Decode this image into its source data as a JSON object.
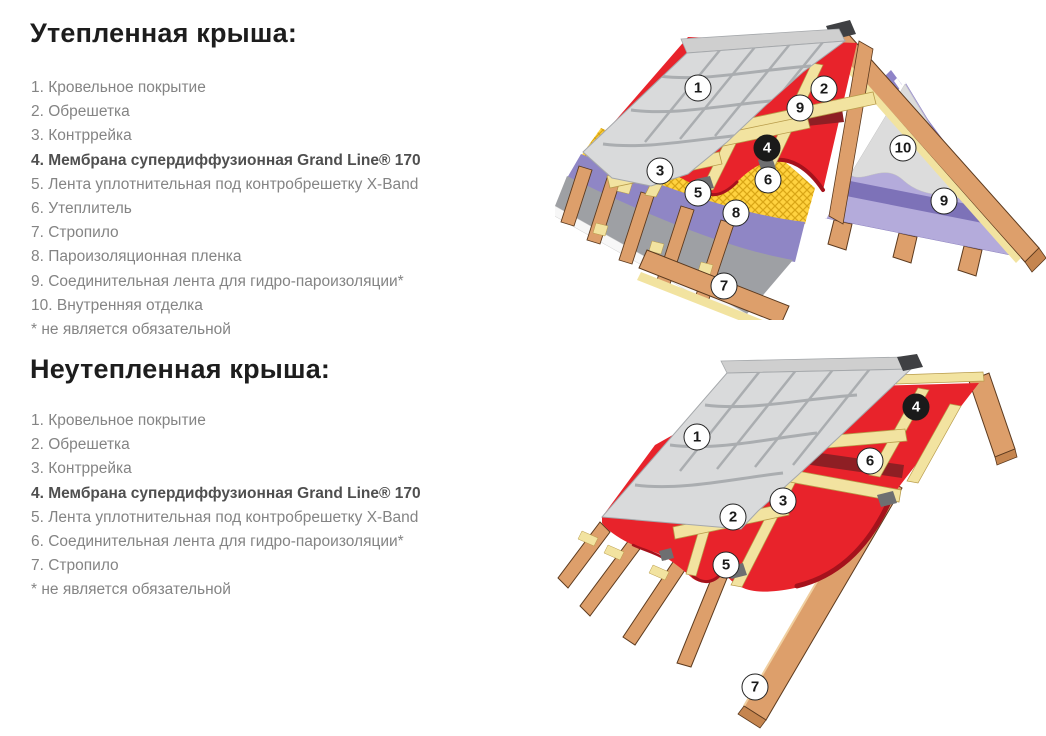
{
  "sections": [
    {
      "heading": "Утепленная крыша:",
      "items": [
        {
          "text": "1. Кровельное покрытие",
          "bold": false
        },
        {
          "text": "2. Обрешетка",
          "bold": false
        },
        {
          "text": "3. Контррейка",
          "bold": false
        },
        {
          "text": "4. Мембрана супердиффузионная Grand Line® 170",
          "bold": true
        },
        {
          "text": "5. Лента уплотнительная под контробрешетку X-Band",
          "bold": false
        },
        {
          "text": "6. Утеплитель",
          "bold": false
        },
        {
          "text": "7. Стропило",
          "bold": false
        },
        {
          "text": "8. Пароизоляционная пленка",
          "bold": false
        },
        {
          "text": "9. Соединительная лента для гидро-пароизоляции*",
          "bold": false
        },
        {
          "text": "10. Внутренняя отделка",
          "bold": false
        }
      ],
      "footnote": "* не является обязательной"
    },
    {
      "heading": "Неутепленная крыша:",
      "items": [
        {
          "text": "1. Кровельное покрытие",
          "bold": false
        },
        {
          "text": "2. Обрешетка",
          "bold": false
        },
        {
          "text": "3. Контррейка",
          "bold": false
        },
        {
          "text": "4. Мембрана супердиффузионная Grand Line® 170",
          "bold": true
        },
        {
          "text": "5. Лента уплотнительная под контробрешетку X-Band",
          "bold": false
        },
        {
          "text": "6. Соединительная лента для гидро-пароизоляции*",
          "bold": false
        },
        {
          "text": "7. Стропило",
          "bold": false
        }
      ],
      "footnote": "* не является обязательной"
    }
  ],
  "diagrams": [
    {
      "name": "insulated-roof-diagram",
      "callouts": [
        {
          "n": "1",
          "x": 143,
          "y": 78,
          "dark": false
        },
        {
          "n": "2",
          "x": 269,
          "y": 79,
          "dark": false
        },
        {
          "n": "9",
          "x": 245,
          "y": 98,
          "dark": false
        },
        {
          "n": "4",
          "x": 212,
          "y": 138,
          "dark": true
        },
        {
          "n": "3",
          "x": 105,
          "y": 161,
          "dark": false
        },
        {
          "n": "6",
          "x": 213,
          "y": 170,
          "dark": false
        },
        {
          "n": "5",
          "x": 143,
          "y": 183,
          "dark": false
        },
        {
          "n": "8",
          "x": 181,
          "y": 203,
          "dark": false
        },
        {
          "n": "10",
          "x": 348,
          "y": 138,
          "dark": false
        },
        {
          "n": "9",
          "x": 389,
          "y": 191,
          "dark": false
        },
        {
          "n": "7",
          "x": 169,
          "y": 276,
          "dark": false
        }
      ]
    },
    {
      "name": "non-insulated-roof-diagram",
      "callouts": [
        {
          "n": "1",
          "x": 142,
          "y": 92,
          "dark": false
        },
        {
          "n": "4",
          "x": 361,
          "y": 62,
          "dark": true
        },
        {
          "n": "6",
          "x": 315,
          "y": 116,
          "dark": false
        },
        {
          "n": "3",
          "x": 228,
          "y": 156,
          "dark": false
        },
        {
          "n": "2",
          "x": 178,
          "y": 172,
          "dark": false
        },
        {
          "n": "5",
          "x": 171,
          "y": 220,
          "dark": false
        },
        {
          "n": "7",
          "x": 200,
          "y": 342,
          "dark": false
        }
      ]
    }
  ],
  "colors": {
    "membrane_red": "#e8232b",
    "tape_dark_red": "#8e1f24",
    "wood_tan": "#dd9f6b",
    "batten_cream": "#f2e3a0",
    "insulation_yellow": "#ffd23f",
    "film_purple": "#8f86c5",
    "tile_gray": "#d9dadb",
    "layer_gray": "#9ea0a4",
    "callout_dark": "#1a1a1a",
    "heading_text": "#1d1d1d",
    "list_text": "#848484"
  }
}
